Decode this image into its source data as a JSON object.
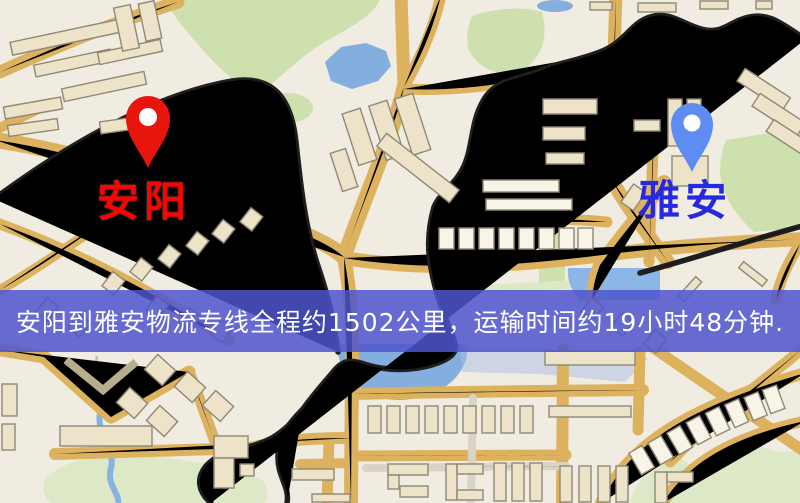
{
  "map": {
    "markers": [
      {
        "name": "origin",
        "label": "安阳",
        "pin_color": "#e8150c",
        "label_color": "#fd0200"
      },
      {
        "name": "destination",
        "label": "雅安",
        "pin_color": "#5e8df2",
        "label_color": "#2629de"
      }
    ],
    "banner": {
      "text": "安阳到雅安物流专线全程约1502公里，运输时间约19小时48分钟.",
      "origin": "安阳",
      "destination": "雅安",
      "distance_km": "1502",
      "duration": "19小时48分钟",
      "background_color": "#5157c9",
      "text_color": "#ffffff"
    },
    "palette": {
      "land": "#f1ece1",
      "road": "#f7d87d",
      "road_casing": "#ddb25f",
      "minor_road": "#fdfcf6",
      "park": "#cfe0af",
      "water": "#83aede",
      "building": "#ece3c9",
      "railway": "#1f1f1f"
    }
  }
}
